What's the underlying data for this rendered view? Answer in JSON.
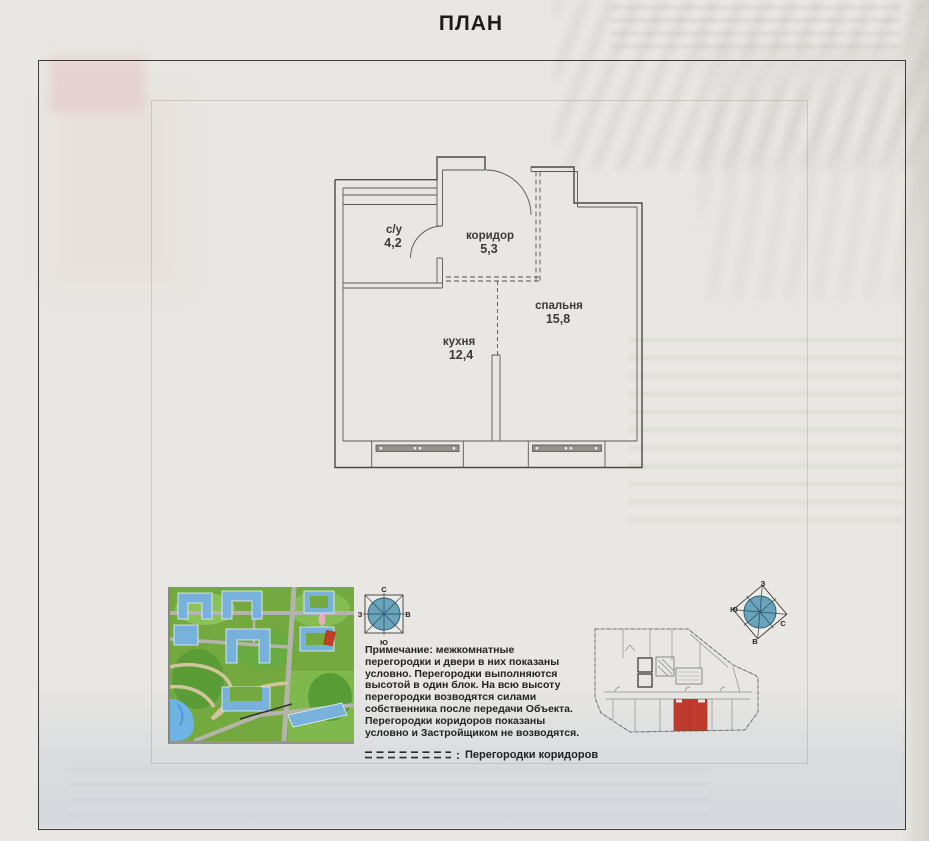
{
  "title": "ПЛАН",
  "floor_plan": {
    "rooms": [
      {
        "name": "с/у",
        "area": "4,2"
      },
      {
        "name": "коридор",
        "area": "5,3"
      },
      {
        "name": "спальня",
        "area": "15,8"
      },
      {
        "name": "кухня",
        "area": "12,4"
      }
    ]
  },
  "note": {
    "label": "Примечание:",
    "text": " межкомнатные перегородки и двери в них показаны условно. Перегородки выполняются высотой в один блок. На всю высоту перегородки возводятся силами собственника после передачи Объекта. Перегородки коридоров показаны условно и Застройщиком не возводятся."
  },
  "legend": {
    "colon": ":",
    "label": "Перегородки коридоров"
  },
  "compass": {
    "north": "С",
    "south": "Ю",
    "east": "В",
    "west": "З"
  },
  "colors": {
    "paper": "#e9e7e3",
    "plan_line": "#4b4a47",
    "highlight_unit": "#bf3b2d",
    "compass_fill": "#6ba3ba",
    "map_green": "#74a93f",
    "map_building": "#79b1dd",
    "map_road": "#b5b4ac",
    "map_water": "#6fb3e4"
  }
}
